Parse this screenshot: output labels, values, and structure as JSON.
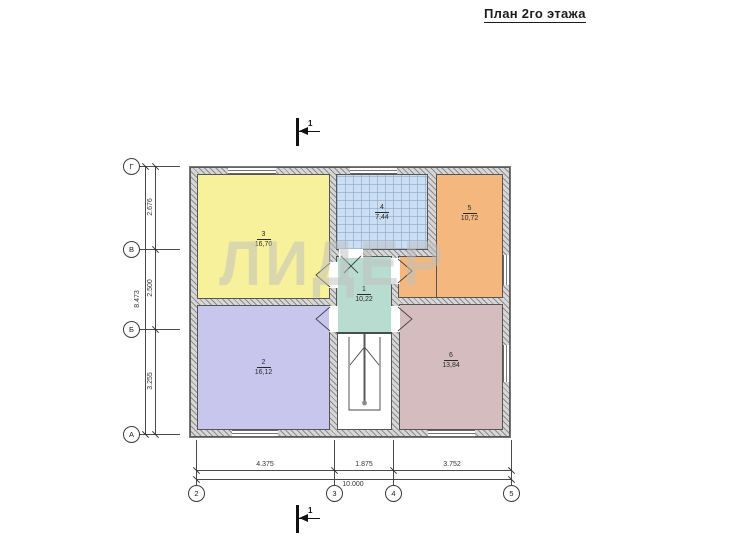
{
  "title": "План 2го этажа",
  "watermark": "ЛИДЕР",
  "section_marks": {
    "top": "1",
    "bottom": "1"
  },
  "rooms": [
    {
      "number": "1",
      "area": "10,22",
      "color": "#b9dcd0",
      "kind": "hall"
    },
    {
      "number": "2",
      "area": "16,12",
      "color": "#c9c6ee",
      "kind": "room"
    },
    {
      "number": "3",
      "area": "16,70",
      "color": "#f8f19c",
      "kind": "room"
    },
    {
      "number": "4",
      "area": "7,44",
      "color": "#ccdef1",
      "kind": "room"
    },
    {
      "number": "5",
      "area": "10,72",
      "color": "#f4b87e",
      "kind": "room"
    },
    {
      "number": "6",
      "area": "13,84",
      "color": "#d5bcbf",
      "kind": "room"
    }
  ],
  "axes": {
    "left": [
      {
        "label": "Г"
      },
      {
        "label": "В"
      },
      {
        "label": "Б"
      },
      {
        "label": "А"
      }
    ],
    "bottom": [
      {
        "label": "2"
      },
      {
        "label": "3"
      },
      {
        "label": "4"
      },
      {
        "label": "5"
      }
    ]
  },
  "dimensions": {
    "left": {
      "segments": [
        "2.676",
        "2.500",
        "3.255"
      ],
      "total": "8.473"
    },
    "bottom": {
      "segments": [
        "4.375",
        "1.875",
        "3.752"
      ],
      "total": "10.000"
    }
  },
  "colors": {
    "wall_fill": "#d7d7d7",
    "wall_hatch": "#8c8c8c",
    "line": "#4a4a4a"
  }
}
